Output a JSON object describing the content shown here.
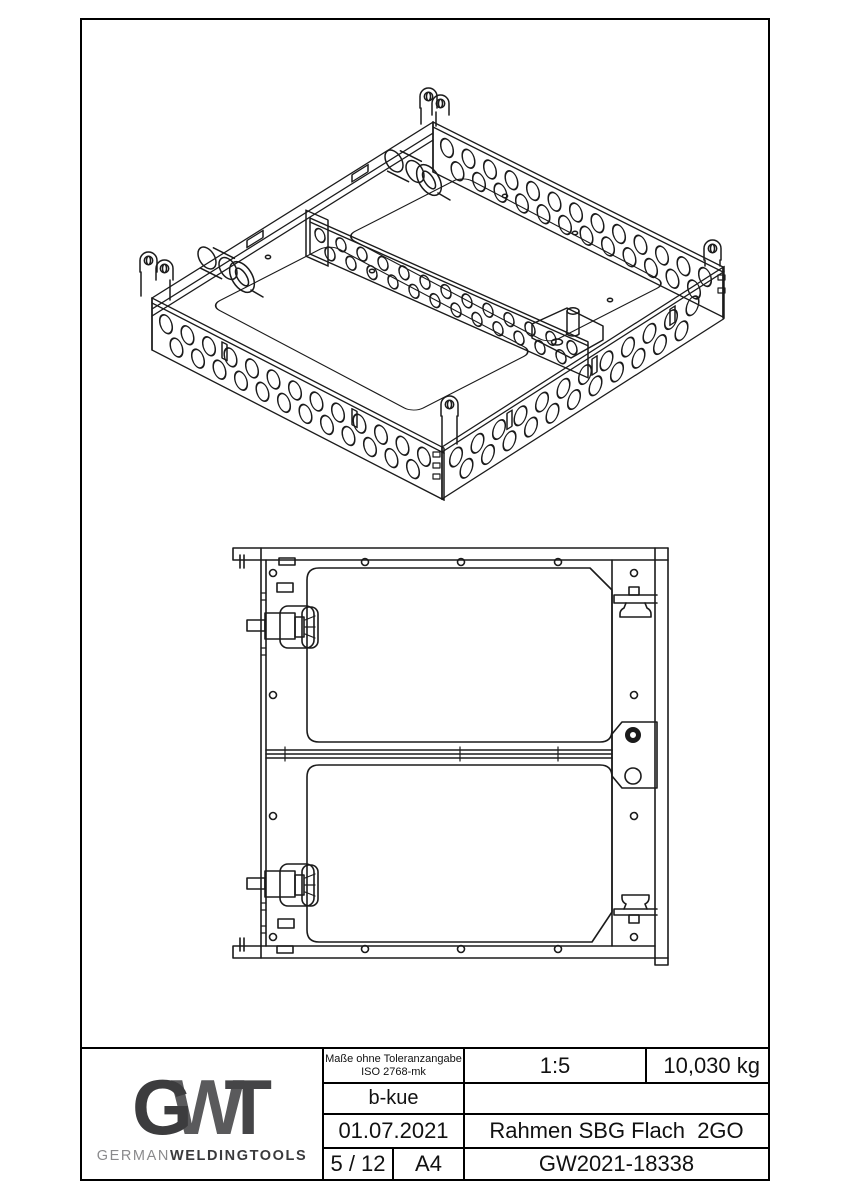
{
  "title_block": {
    "logo": {
      "g": "G",
      "w": "W",
      "t": "T",
      "wordmark_light": "GERMAN",
      "wordmark_bold": "WELDINGTOOLS"
    },
    "tolerance_note_line1": "Maße ohne Toleranzangabe",
    "tolerance_note_line2": "ISO 2768-mk",
    "scale": "1:5",
    "weight": "10,030 kg",
    "author": "b-kue",
    "date": "01.07.2021",
    "part_name": "Rahmen SBG Flach  2GO",
    "sheet_number": "5 / 12",
    "paper_format": "A4",
    "drawing_number": "GW2021-18338"
  },
  "colors": {
    "line": "#1b1b1b",
    "border": "#000000",
    "logo_dark": "#3c3c3e",
    "logo_mid": "#5a5a5c",
    "logo_light": "#8a8a8c"
  }
}
